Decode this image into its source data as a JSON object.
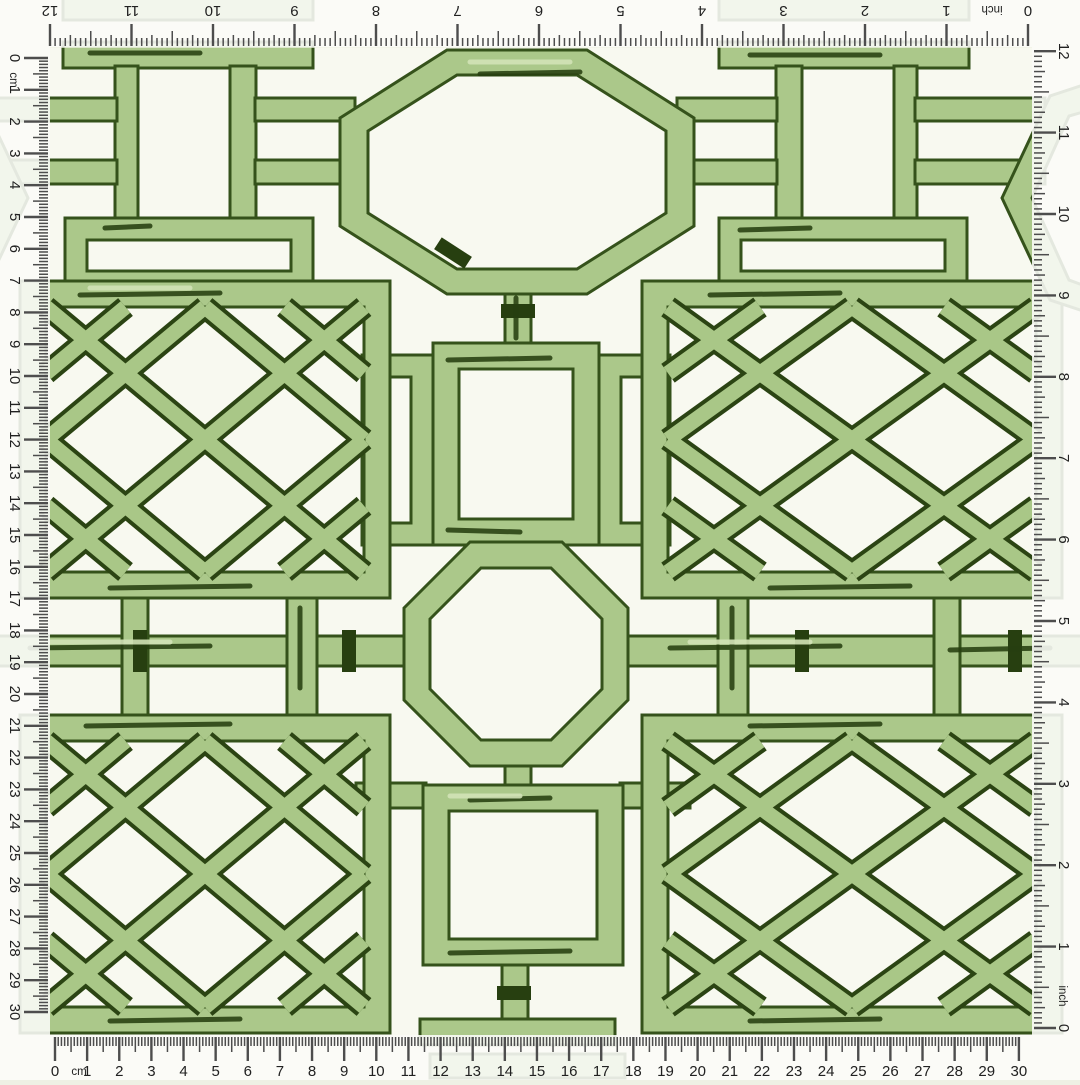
{
  "rulers": {
    "top": {
      "unit_label": "inch",
      "labels": [
        "0",
        "1",
        "2",
        "3",
        "4",
        "5",
        "6",
        "7",
        "8",
        "9",
        "10",
        "11",
        "12"
      ]
    },
    "right": {
      "unit_label": "inch",
      "labels": [
        "0",
        "1",
        "2",
        "3",
        "4",
        "5",
        "6",
        "7",
        "8",
        "9",
        "10",
        "11",
        "12"
      ]
    },
    "bottom": {
      "unit_label": "cm",
      "labels": [
        "0",
        "1",
        "2",
        "3",
        "4",
        "5",
        "6",
        "7",
        "8",
        "9",
        "10",
        "11",
        "12",
        "13",
        "14",
        "15",
        "16",
        "17",
        "18",
        "19",
        "20",
        "21",
        "22",
        "23",
        "24",
        "25",
        "26",
        "27",
        "28",
        "29",
        "30"
      ]
    },
    "left": {
      "unit_label": "cm",
      "labels": [
        "0",
        "1",
        "2",
        "3",
        "4",
        "5",
        "6",
        "7",
        "8",
        "9",
        "10",
        "11",
        "12",
        "13",
        "14",
        "15",
        "16",
        "17",
        "18",
        "19",
        "20",
        "21",
        "22",
        "23",
        "24",
        "25",
        "26",
        "27",
        "28",
        "29",
        "30"
      ]
    }
  },
  "colors": {
    "background": "#f3f5e9",
    "swatch_background": "#f8f9f0",
    "bamboo_light": "#abc88a",
    "bamboo_highlight": "#d2e2b6",
    "bamboo_outline": "#35521b",
    "bamboo_ink": "#273f10",
    "lattice_dark": "#2b4413",
    "lattice_light": "#a9c787",
    "ruler_strip": "rgba(255,255,255,0.62)",
    "tick": "#4d4d4d",
    "label": "#212121"
  }
}
